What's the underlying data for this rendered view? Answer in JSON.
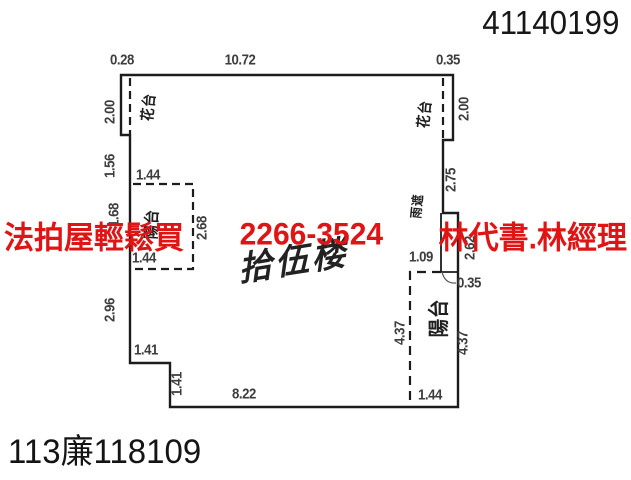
{
  "document": {
    "corner_number": "41140199",
    "file_number": "113廉118109",
    "floor_label": "拾伍楼"
  },
  "watermark": {
    "parts": [
      "法拍屋輕鬆買",
      "2266-3524",
      "林代書.林經理"
    ],
    "color": "#e01414"
  },
  "colors": {
    "plan_line": "#1c1c1c",
    "dimension_text": "#3d3d3d"
  },
  "plan": {
    "dimension_labels": [
      {
        "text": "0.28",
        "x": 122,
        "y": 60
      },
      {
        "text": "10.72",
        "x": 240,
        "y": 60
      },
      {
        "text": "0.35",
        "x": 448,
        "y": 60
      },
      {
        "text": "2.00",
        "x": 110,
        "y": 112,
        "rot": -90
      },
      {
        "text": "1.56",
        "x": 110,
        "y": 166,
        "rot": -90
      },
      {
        "text": "1.44",
        "x": 148,
        "y": 175
      },
      {
        "text": "1.68",
        "x": 114,
        "y": 215,
        "rot": -90
      },
      {
        "text": "2.68",
        "x": 202,
        "y": 228,
        "rot": -90
      },
      {
        "text": "1.44",
        "x": 144,
        "y": 258
      },
      {
        "text": "2.96",
        "x": 110,
        "y": 310,
        "rot": -90
      },
      {
        "text": "1.41",
        "x": 146,
        "y": 350
      },
      {
        "text": "1.41",
        "x": 177,
        "y": 384,
        "rot": -90
      },
      {
        "text": "8.22",
        "x": 244,
        "y": 394
      },
      {
        "text": "2.00",
        "x": 464,
        "y": 109,
        "rot": -90
      },
      {
        "text": "2.75",
        "x": 451,
        "y": 180,
        "rot": -90
      },
      {
        "text": "2.62",
        "x": 470,
        "y": 248,
        "rot": -90
      },
      {
        "text": "1.09",
        "x": 421,
        "y": 257
      },
      {
        "text": "0.35",
        "x": 469,
        "y": 283
      },
      {
        "text": "4.37",
        "x": 400,
        "y": 333,
        "rot": -90
      },
      {
        "text": "4.37",
        "x": 463,
        "y": 343,
        "rot": -90
      },
      {
        "text": "1.44",
        "x": 430,
        "y": 395
      }
    ],
    "area_labels": [
      {
        "text": "花台",
        "x": 148,
        "y": 107,
        "rot": -84,
        "size": 15
      },
      {
        "text": "花台",
        "x": 424,
        "y": 114,
        "rot": -84,
        "size": 15
      },
      {
        "text": "陽台",
        "x": 150,
        "y": 224,
        "rot": -87,
        "size": 16
      },
      {
        "text": "雨遮",
        "x": 416,
        "y": 206,
        "rot": -84,
        "size": 13
      },
      {
        "text": "陽台",
        "x": 438,
        "y": 318,
        "rot": -90,
        "size": 21
      }
    ]
  }
}
